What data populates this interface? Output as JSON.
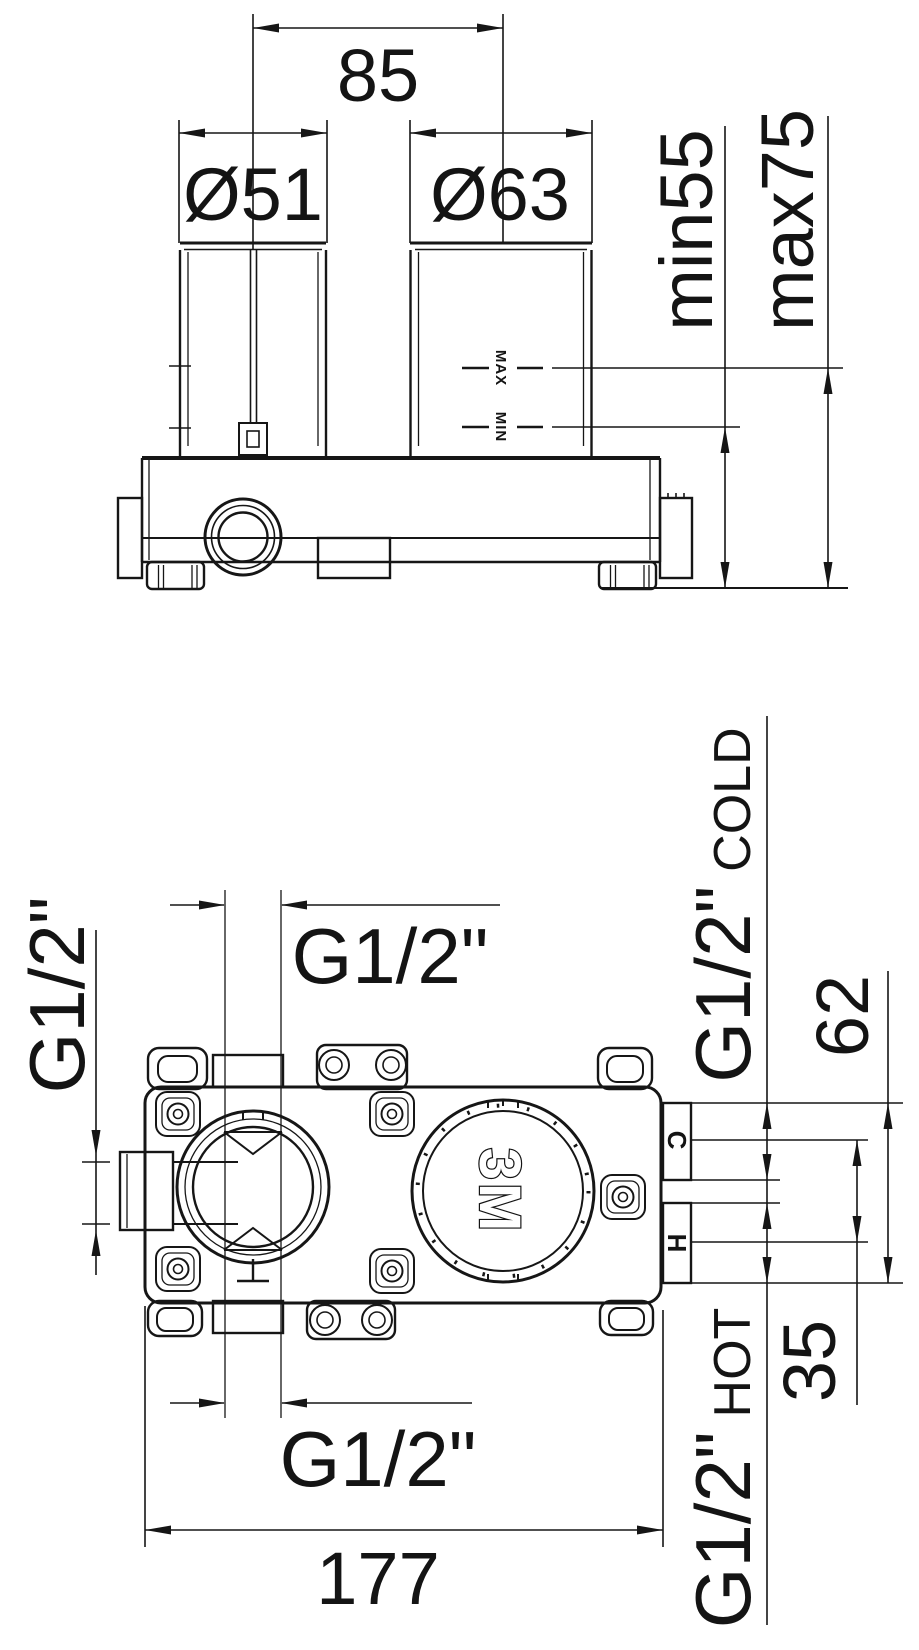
{
  "colors": {
    "line": "#161616",
    "text": "#141414",
    "background": "#ffffff"
  },
  "front_view": {
    "dim_center_spacing": "85",
    "dim_left_sleeve_diameter": "Ø51",
    "dim_right_sleeve_diameter": "Ø63",
    "dim_depth_min": "min55",
    "dim_depth_max": "max75",
    "marker_max": "MAX",
    "marker_min": "MIN"
  },
  "plan_view": {
    "dim_top_outlet_thread": "G1/2\"",
    "dim_left_outlet_thread": "G1/2\"",
    "dim_bottom_outlet_thread": "G1/2\"",
    "dim_overall_width": "177",
    "dim_cold_inlet_thread": "G1/2\"",
    "dim_cold_inlet_word": "COLD",
    "dim_hot_inlet_thread": "G1/2\"",
    "dim_hot_inlet_word": "HOT",
    "dim_inlet_span": "62",
    "dim_inlet_centers": "35",
    "marker_cold": "C",
    "marker_hot": "H",
    "marker_logo": "3M"
  }
}
